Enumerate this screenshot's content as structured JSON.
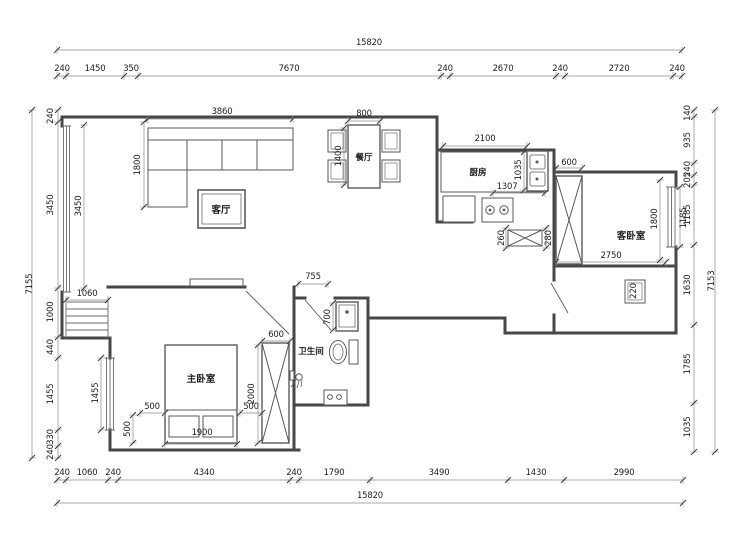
{
  "plan": {
    "dims": {
      "top_overall": "15820",
      "top": [
        "240",
        "1450",
        "350",
        "7670",
        "240",
        "2670",
        "240",
        "2720",
        "240"
      ],
      "bottom": [
        "240",
        "1060",
        "240",
        "4340",
        "240",
        "1790",
        "3490",
        "1430",
        "2990"
      ],
      "bottom_overall": "15820",
      "left_overall": "7155",
      "left": [
        "240",
        "3450",
        "1000",
        "440",
        "1455",
        "330",
        "240"
      ],
      "right": [
        "140",
        "935",
        "240",
        "205",
        "1185",
        "1630",
        "1785",
        "1035"
      ],
      "right_overall": "7153"
    },
    "inner": {
      "sofa_len": "3860",
      "sofa_depth": "1800",
      "living_window": "3450",
      "side_bay": "1060",
      "dining_w": "800",
      "dining_l": "1400",
      "kitchen_counter": "2100",
      "kitchen_depth": "1035",
      "counter_run": "1307",
      "radiator_depth": "260",
      "radiator_side": "280",
      "guest_wardrobe": "600",
      "guest_width": "2750",
      "guest_window": "1800",
      "guest_window_out": "1185",
      "guest_unit": "220",
      "bath_door": "755",
      "bath_sink": "700",
      "master_wardrobe_w": "600",
      "master_wardrobe_l": "2000",
      "bed_side_a": "500",
      "bed_side_b": "500",
      "bed_side_c": "500",
      "bed_width": "1900",
      "master_window": "1455"
    },
    "rooms": {
      "living": "客厅",
      "dining": "餐厅",
      "kitchen": "厨房",
      "bath": "卫生间",
      "master": "主卧室",
      "guest": "客卧室"
    },
    "colors": {
      "wall": "#474747",
      "furniture": "#5a5a5a",
      "dimline": "#8a8a8a",
      "text": "#222222"
    }
  }
}
